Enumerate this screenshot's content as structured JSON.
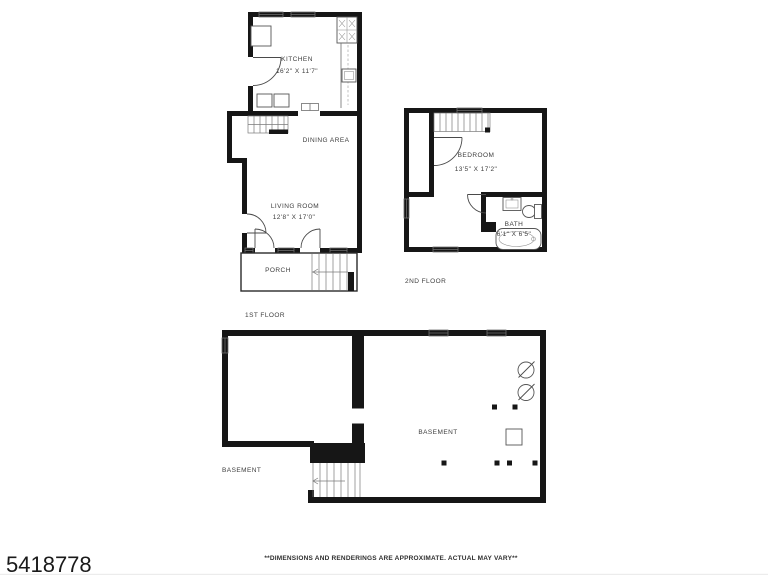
{
  "page": {
    "listing_id": "5418778",
    "disclaimer": "**DIMENSIONS AND RENDERINGS ARE APPROXIMATE. ACTUAL MAY VARY**"
  },
  "floors": {
    "first": {
      "label": "1ST FLOOR",
      "kitchen_name": "KITCHEN",
      "kitchen_dims": "16'2\" X 11'7\"",
      "dining_name": "DINING AREA",
      "living_name": "LIVING ROOM",
      "living_dims": "12'8\" X 17'0\"",
      "porch_name": "PORCH"
    },
    "second": {
      "label": "2ND FLOOR",
      "bedroom_name": "BEDROOM",
      "bedroom_dims": "13'5\" X 17'2\"",
      "bath_name": "BATH",
      "bath_dims": "6'1\" X 6'5\""
    },
    "basement": {
      "label_outside": "BASEMENT",
      "room_name": "BASEMENT"
    }
  },
  "colors": {
    "wall": "#161616",
    "detail_line": "#6e6e6e",
    "label_text": "#3d3d3d"
  }
}
